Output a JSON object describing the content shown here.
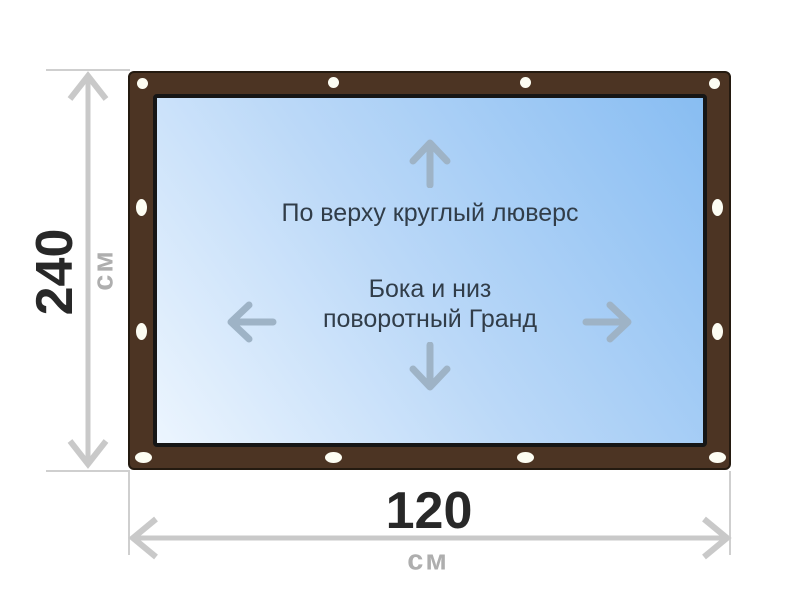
{
  "diagram": {
    "product": {
      "top_fastening_note": "По верху круглый люверс",
      "side_fastening_note_line1": "Бока и низ",
      "side_fastening_note_line2": "поворотный Гранд"
    },
    "dimensions": {
      "height": {
        "value": "240",
        "unit": "см"
      },
      "width": {
        "value": "120",
        "unit": "см"
      }
    },
    "icons": {
      "top_edge": "round-grommet-icon",
      "sides_and_bottom": "oval-fastener-icon",
      "directions": [
        "arrow-up-icon",
        "arrow-down-icon",
        "arrow-left-icon",
        "arrow-right-icon"
      ],
      "dimension_markers": [
        "double-arrow-vertical-icon",
        "double-arrow-horizontal-icon"
      ]
    }
  },
  "colors": {
    "frame_brown": "#4c3423",
    "frame_border": "#241a10",
    "panel_border": "#161616",
    "panel_gradient_start": "#ecf5fe",
    "panel_gradient_end": "#88bdf2",
    "grommet": "#fdfdf3",
    "direction_arrow": "#9eb3c6",
    "note_text": "#313d49",
    "dimension_line": "#c9c9c9",
    "extension_line": "#cfcfcf",
    "dimension_value": "#282828",
    "dimension_unit": "#aeaeae"
  }
}
